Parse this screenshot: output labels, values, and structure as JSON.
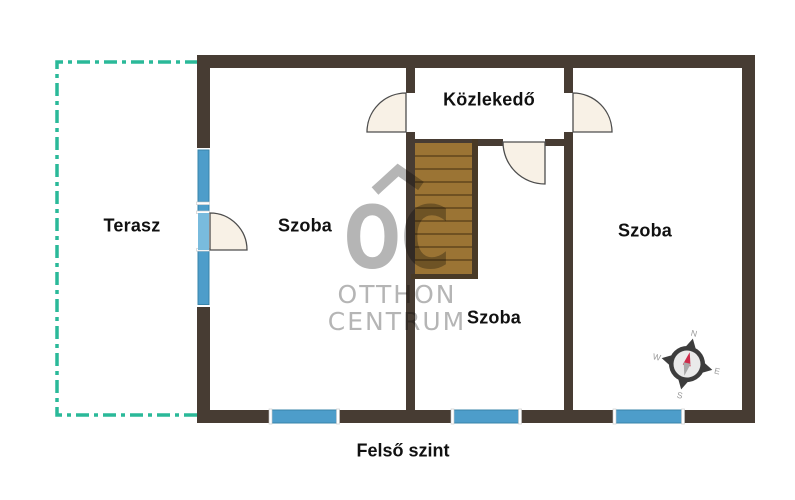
{
  "floorplan": {
    "floor_label": "Felső szint",
    "rooms": {
      "terrace": {
        "label": "Terasz"
      },
      "room_left": {
        "label": "Szoba"
      },
      "hallway": {
        "label": "Közlekedő"
      },
      "room_middle": {
        "label": "Szoba"
      },
      "room_right": {
        "label": "Szoba"
      }
    },
    "features": {
      "stairs": "staircase",
      "windows": 6,
      "doors": 4
    }
  },
  "watermark": {
    "logo": "OC",
    "line1": "OTTHON",
    "line2": "CENTRUM"
  },
  "compass": {
    "north": "N",
    "east": "E",
    "south": "S",
    "west": "W"
  },
  "colors": {
    "wall": "#473c33",
    "terrace_outline": "#2ab999",
    "window": "#4d9dca",
    "window_border": "#3884a9",
    "door_leaf_blue": "#79bbdd",
    "door_fill": "#f8f1e6",
    "door_stroke": "#4d4d4d",
    "stair_wood": "#9b7434",
    "stair_stripe": "#6f5122",
    "stair_border": "#493a26",
    "watermark_gray": "#b5b5b5",
    "compass_ring": "#3d3d3d",
    "compass_face": "#eaeaea",
    "needle_north": "#ce2b4a",
    "needle_south": "#a8a8a8",
    "compass_letters": "#9a9a9a",
    "text": "#111111",
    "seam": "#ffffff"
  }
}
